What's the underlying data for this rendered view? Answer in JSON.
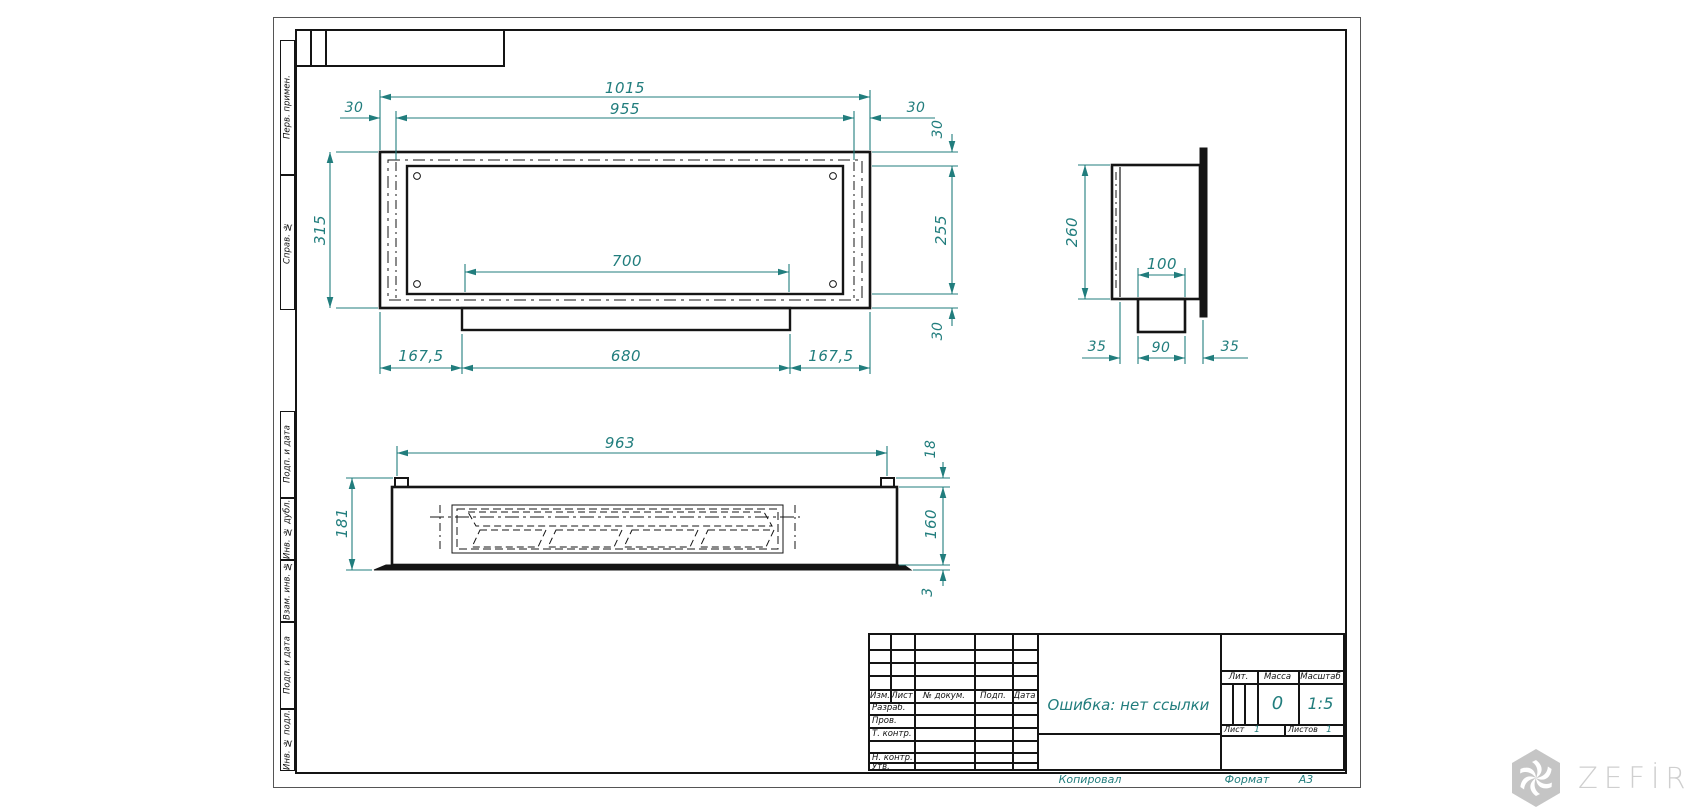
{
  "colors": {
    "dimension": "#217d7d",
    "line": "#141414",
    "watermark": "#c5c5c5"
  },
  "margin_labels": {
    "boxes": [
      "Перв. примен.",
      "Справ. №",
      "Подп. и дата",
      "Инв. № дубл.",
      "Взам. инв. №",
      "Подп. и дата",
      "Инв. № подл."
    ]
  },
  "dims": {
    "top_view": {
      "overall_width": "1015",
      "inner_width": "955",
      "flange_left": "30",
      "flange_right": "30",
      "wall_top": "30",
      "opening_height": "255",
      "wall_bottom": "30",
      "height": "315",
      "opening_width": "700",
      "offset_left": "167,5",
      "lip_width": "680",
      "offset_right": "167,5"
    },
    "side_view": {
      "height": "260",
      "neck_width": "100",
      "left_offset": "35",
      "spigot_width": "90",
      "right_offset": "35"
    },
    "front_view": {
      "width": "963",
      "height": "181",
      "tab_height": "18",
      "body_height": "160",
      "base_thickness": "3"
    }
  },
  "title_block": {
    "headers": [
      "Изм.",
      "Лист",
      "№ докум.",
      "Подп.",
      "Дата"
    ],
    "roles": [
      "Разраб.",
      "Пров.",
      "Т. контр.",
      "Н. контр.",
      "Утв."
    ],
    "designation": "Ошибка: нет ссылки",
    "lit_label": "Лит.",
    "mass_label": "Масса",
    "scale_label": "Масштаб",
    "mass_value": "0",
    "scale_value": "1:5",
    "sheet_label": "Лист",
    "sheet_value": "1",
    "sheets_label": "Листов",
    "sheets_value": "1",
    "copied_label": "Копировал",
    "format_label": "Формат",
    "format_value": "А3"
  },
  "watermark": {
    "text": "ZEFİRE"
  }
}
